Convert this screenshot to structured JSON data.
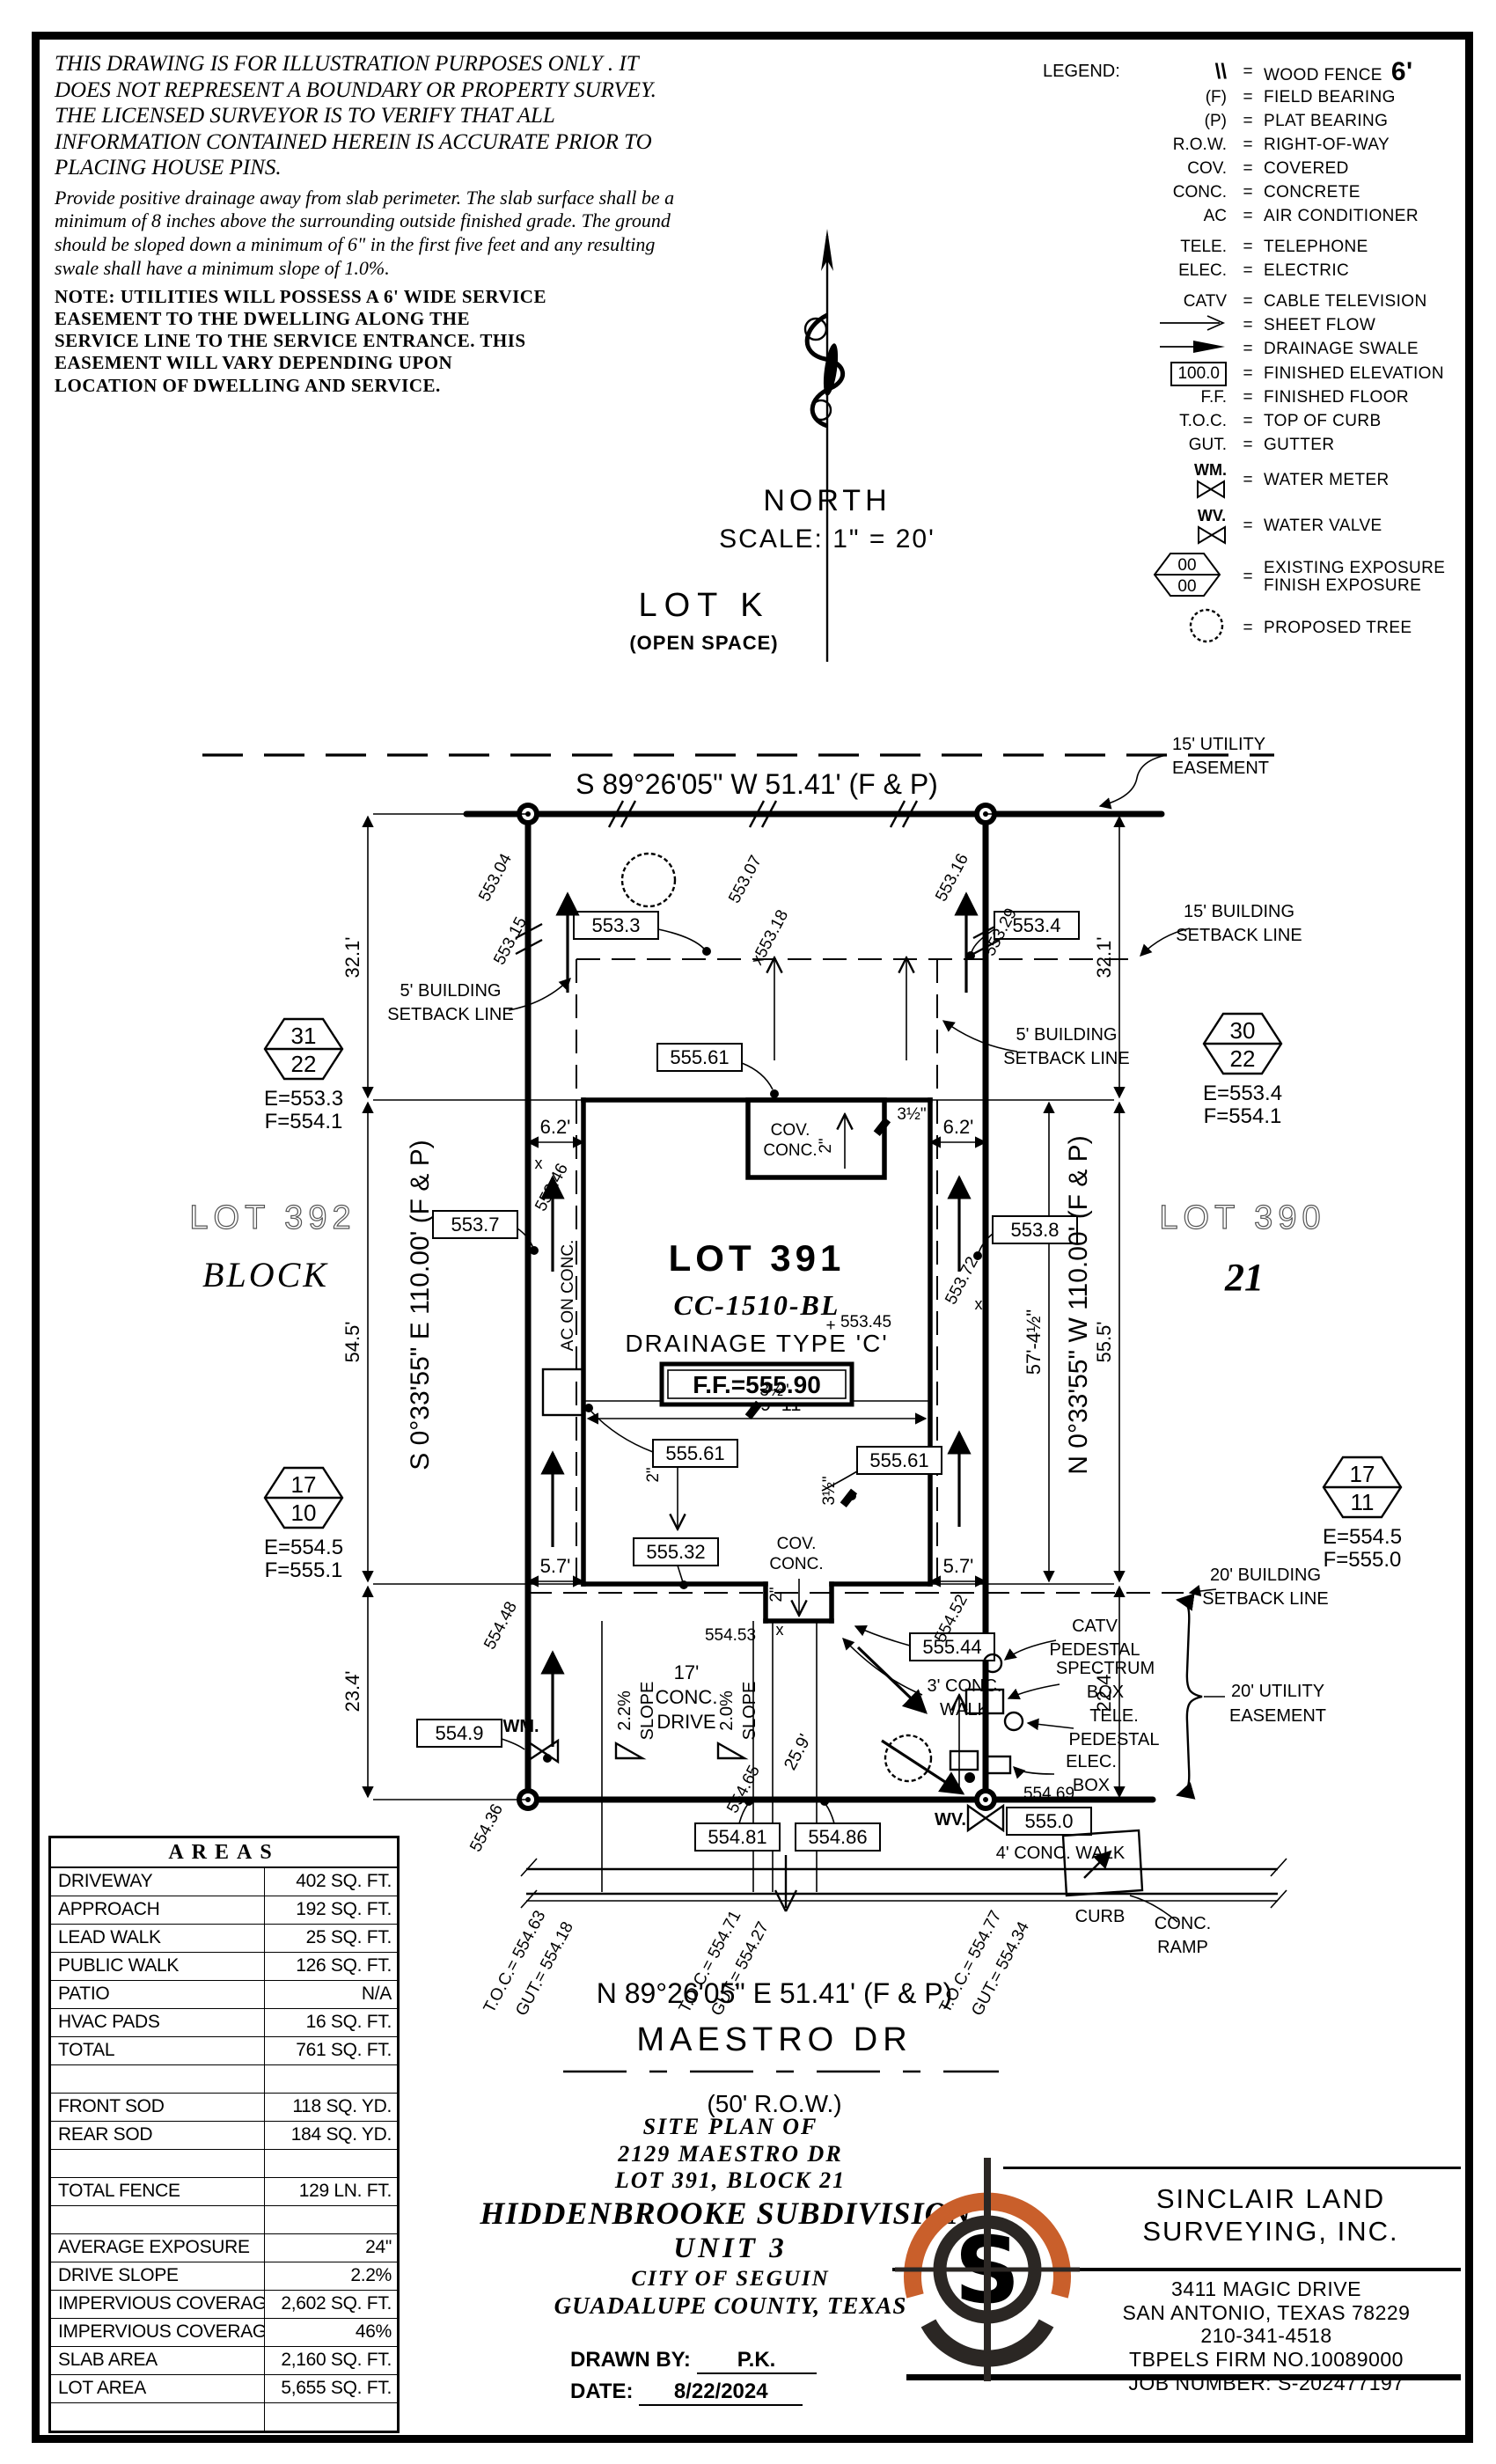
{
  "notes": {
    "disclaimer": "THIS DRAWING IS FOR ILLUSTRATION PURPOSES ONLY . IT DOES NOT REPRESENT A BOUNDARY OR PROPERTY SURVEY. THE LICENSED SURVEYOR IS TO VERIFY THAT ALL INFORMATION CONTAINED HEREIN IS ACCURATE PRIOR TO PLACING HOUSE PINS.",
    "drainage_note": "Provide positive drainage away from slab perimeter. The slab surface shall be a minimum of 8 inches above the surrounding outside finished grade. The ground should be sloped down a minimum of 6\" in the first five feet and any resulting swale shall have a minimum slope of 1.0%.",
    "utility_note": "NOTE: UTILITIES WILL POSSESS A 6' WIDE SERVICE EASEMENT TO THE DWELLING ALONG THE SERVICE LINE TO THE SERVICE ENTRANCE. THIS EASEMENT WILL VARY DEPENDING UPON LOCATION OF DWELLING AND SERVICE."
  },
  "legend": {
    "title": "LEGEND:",
    "eq": "=",
    "items": [
      {
        "sym": "\\\\",
        "label": "WOOD FENCE",
        "extra": "6'"
      },
      {
        "sym": "(F)",
        "label": "FIELD BEARING"
      },
      {
        "sym": "(P)",
        "label": "PLAT BEARING"
      },
      {
        "sym": "R.O.W.",
        "label": "RIGHT-OF-WAY"
      },
      {
        "sym": "COV.",
        "label": "COVERED"
      },
      {
        "sym": "CONC.",
        "label": "CONCRETE"
      },
      {
        "sym": "AC",
        "label": "AIR CONDITIONER"
      },
      {
        "sym": "TELE.",
        "label": "TELEPHONE"
      },
      {
        "sym": "ELEC.",
        "label": "ELECTRIC"
      },
      {
        "sym": "CATV",
        "label": "CABLE TELEVISION"
      },
      {
        "sym": "sheet-flow-arrow",
        "label": "SHEET FLOW"
      },
      {
        "sym": "drainage-swale-arrow",
        "label": "DRAINAGE SWALE"
      },
      {
        "sym": "100.0",
        "label": "FINISHED ELEVATION"
      },
      {
        "sym": "F.F.",
        "label": "FINISHED FLOOR"
      },
      {
        "sym": "T.O.C.",
        "label": "TOP OF CURB"
      },
      {
        "sym": "GUT.",
        "label": "GUTTER"
      },
      {
        "sym": "WM.",
        "label": "WATER METER"
      },
      {
        "sym": "WV.",
        "label": "WATER VALVE"
      },
      {
        "sym": "00",
        "sym2": "00",
        "label": "EXISTING EXPOSURE",
        "label2": "FINISH EXPOSURE"
      },
      {
        "sym": "proposed-tree",
        "label": "PROPOSED TREE"
      }
    ]
  },
  "compass": {
    "north": "NORTH",
    "scale": "SCALE:  1\" = 20'"
  },
  "openspace": {
    "name": "LOT K",
    "sub": "(OPEN SPACE)"
  },
  "plan": {
    "bearing_top": "S 89°26'05\" W 51.41' (F & P)",
    "bearing_bottom": "N 89°26'05\" E 51.41' (F & P)",
    "bearing_left": "S 0°33'55\" E 110.00' (F & P)",
    "bearing_right": "N 0°33'55\" W 110.00' (F & P)",
    "street": "MAESTRO DR",
    "row": "(50' R.O.W.)",
    "lot_label": "LOT 391",
    "model": "CC-1510-BL",
    "drainage_type": "DRAINAGE TYPE 'C'",
    "ff": "F.F.=555.90",
    "ff_spot": "553.45",
    "plus": "+",
    "lot_left": "LOT 392",
    "block_word": "BLOCK",
    "lot_right": "LOT 390",
    "block_num": "21",
    "esmt15_1": "15' UTILITY",
    "esmt15_2": "EASEMENT",
    "sb15_1": "15' BUILDING",
    "sb15_2": "SETBACK LINE",
    "sb5_1": "5' BUILDING",
    "sb5_2": "SETBACK LINE",
    "sb20_1": "20' BUILDING",
    "sb20_2": "SETBACK LINE",
    "ue20_1": "20' UTILITY",
    "ue20_2": "EASEMENT",
    "cov": "COV.",
    "conc": "CONC.",
    "ac": "AC ON CONC.",
    "d321": "32.1'",
    "d545": "54.5'",
    "d234": "23.4'",
    "d555": "55.5'",
    "d224": "22.4'",
    "d62": "6.2'",
    "d57": "5.7'",
    "d3911": "39'-11\"",
    "d5745": "57'-4½\"",
    "d2": "2\"",
    "d35": "3½\"",
    "d259": "25.9'",
    "drive1": "17'",
    "drive2": "CONC.",
    "drive3": "DRIVE",
    "slope22": "2.2%",
    "slope20": "2.0%",
    "slope_word": "SLOPE",
    "walk3_1": "3' CONC.",
    "walk3_2": "WALK",
    "walk4": "4' CONC. WALK",
    "curb": "CURB",
    "catv1": "CATV",
    "catv2": "PEDESTAL",
    "spec1": "SPECTRUM",
    "spec2": "BOX",
    "tele1": "TELE.",
    "tele2": "PEDESTAL",
    "elec1": "ELEC.",
    "elec2": "BOX",
    "ramp1": "CONC.",
    "ramp2": "RAMP",
    "wm": "WM.",
    "wv": "WV.",
    "v5533": "553.3",
    "v5534": "553.4",
    "v5537": "553.7",
    "v5538": "553.8",
    "v55561": "555.61",
    "v55532": "555.32",
    "v55544": "555.44",
    "v5549": "554.9",
    "v55481": "554.81",
    "v55486": "554.86",
    "v5550": "555.0",
    "p55304": "553.04",
    "p55315": "553.15",
    "p55307": "553.07",
    "p55318": "x553.18",
    "p55316": "553.16",
    "p55329": "553.29",
    "p55346": "553.46",
    "p55372": "553.72",
    "p55448": "554.48",
    "p55436": "554.36",
    "p55452": "554.52",
    "p55465": "554.65",
    "p55453": "554.53",
    "p55469": "554.69",
    "toc1a": "T.O.C.= 554.63",
    "toc1b": "GUT.= 554.18",
    "toc2a": "T.O.C.= 554.71",
    "toc2b": "GUT.= 554.27",
    "toc3a": "T.O.C.= 554.77",
    "toc3b": "GUT.= 554.34",
    "hex1t": "31",
    "hex1b": "22",
    "hex1e": "E=553.3",
    "hex1f": "F=554.1",
    "hex2t": "30",
    "hex2b": "22",
    "hex2e": "E=553.4",
    "hex2f": "F=554.1",
    "hex3t": "17",
    "hex3b": "10",
    "hex3e": "E=554.5",
    "hex3f": "F=555.1",
    "hex4t": "17",
    "hex4b": "11",
    "hex4e": "E=554.5",
    "hex4f": "F=555.0"
  },
  "areas": {
    "title": "AREAS",
    "rows": [
      {
        "label": "DRIVEWAY",
        "value": "402 SQ. FT."
      },
      {
        "label": "APPROACH",
        "value": "192 SQ. FT."
      },
      {
        "label": "LEAD WALK",
        "value": "25 SQ. FT."
      },
      {
        "label": "PUBLIC WALK",
        "value": "126 SQ. FT."
      },
      {
        "label": "PATIO",
        "value": "N/A"
      },
      {
        "label": "HVAC PADS",
        "value": "16 SQ. FT."
      },
      {
        "label": "TOTAL",
        "value": "761 SQ. FT."
      },
      {
        "label": "",
        "value": ""
      },
      {
        "label": "FRONT SOD",
        "value": "118 SQ. YD."
      },
      {
        "label": "REAR SOD",
        "value": "184 SQ. YD."
      },
      {
        "label": "",
        "value": ""
      },
      {
        "label": "TOTAL FENCE",
        "value": "129 LN. FT."
      },
      {
        "label": "",
        "value": ""
      },
      {
        "label": "AVERAGE EXPOSURE",
        "value": "24\""
      },
      {
        "label": "DRIVE SLOPE",
        "value": "2.2%"
      },
      {
        "label": "IMPERVIOUS COVERAGE",
        "value": "2,602 SQ. FT."
      },
      {
        "label": "IMPERVIOUS COVERAGE %",
        "value": "46%"
      },
      {
        "label": "SLAB AREA",
        "value": "2,160 SQ. FT."
      },
      {
        "label": "LOT AREA",
        "value": "5,655 SQ. FT."
      },
      {
        "label": "",
        "value": ""
      }
    ]
  },
  "titleblock": {
    "l1": "SITE PLAN OF",
    "l2": "2129 MAESTRO DR",
    "l3": "LOT 391, BLOCK 21",
    "l4": "HIDDENBROOKE SUBDIVISION,",
    "l5": "UNIT 3",
    "l6": "CITY OF SEGUIN",
    "l7": "GUADALUPE COUNTY, TEXAS",
    "drawn_label": "DRAWN BY:",
    "drawn": "P.K.",
    "date_label": "DATE:",
    "date": "8/22/2024"
  },
  "company": {
    "name1": "SINCLAIR LAND",
    "name2": "SURVEYING, INC.",
    "addr1": "3411 MAGIC DRIVE",
    "addr2": "SAN ANTONIO, TEXAS 78229",
    "phone": "210-341-4518",
    "firm": "TBPELS FIRM NO.10089000",
    "job": "JOB NUMBER: S-202477197",
    "logo_orange": "#c95f2b",
    "logo_black": "#2b2724",
    "logo_letter": "S"
  }
}
